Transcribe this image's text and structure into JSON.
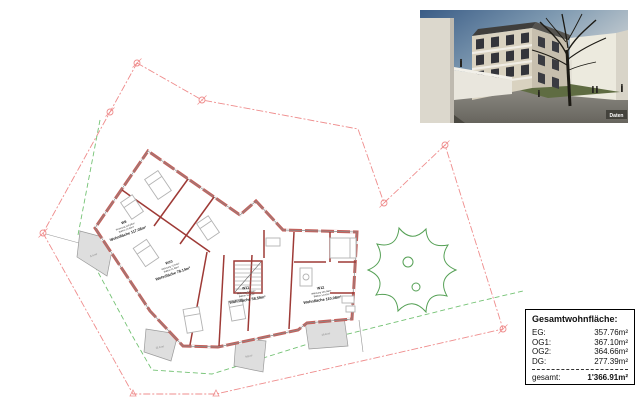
{
  "rendering": {
    "caption": "Daten"
  },
  "plan": {
    "apartments": [
      {
        "id": "W9",
        "line1": "Wohnung 110.08m²",
        "line2": "Balkon 14.00m²",
        "area": "Wohnfläche 117.08m²"
      },
      {
        "id": "W10",
        "line1": "Wohnung 72.64m²",
        "line2": "Balkon 11.00m²",
        "area": "Wohnfläche 78.14m²"
      },
      {
        "id": "W11",
        "line1": "Wohnung 53.09m²",
        "line2": "Balkon 11.00m²",
        "area": "Wohnfläche 58.59m²"
      },
      {
        "id": "W12",
        "line1": "Wohnung 103.08m²",
        "line2": "Balkon 14.00m²",
        "area": "Wohnfläche 110.08m²"
      }
    ],
    "terraces": [
      {
        "label": "5.4 m²"
      },
      {
        "label": "11.9 m²"
      },
      {
        "label": "9.8 m²"
      },
      {
        "label": "16.8 m²"
      }
    ]
  },
  "summary": {
    "title": "Gesamtwohnfläche:",
    "rows": [
      {
        "label": "EG:",
        "value": "357.76m²"
      },
      {
        "label": "OG1:",
        "value": "367.10m²"
      },
      {
        "label": "OG2:",
        "value": "364.66m²"
      },
      {
        "label": "DG:",
        "value": "277.39m²"
      }
    ],
    "total_label": "gesamt:",
    "total_value": "1'366.91m²"
  },
  "colors": {
    "boundary_red": "#ef8d8d",
    "setback_green": "#74c274",
    "wall_dark": "#9e3a36",
    "wall_fill": "#c4615c",
    "tree_green": "#55a055",
    "terrace_gray": "#dedede"
  }
}
